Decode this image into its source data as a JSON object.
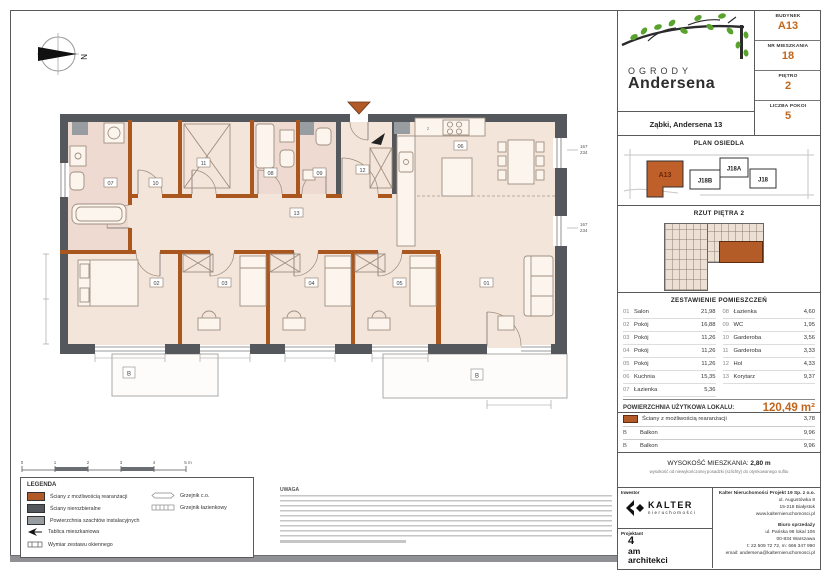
{
  "colors": {
    "accent": "#c2661c",
    "wall_accent": "#a9571f",
    "wall_dark": "#54585c",
    "shaft_gray": "#989da1",
    "floor": "#f3e5d9",
    "bath_floor": "#eedad0"
  },
  "compass": {
    "north": "N"
  },
  "plan": {
    "labels": [
      "01",
      "02",
      "03",
      "04",
      "05",
      "06",
      "07",
      "08",
      "09",
      "10",
      "11",
      "12",
      "13"
    ],
    "balcony_label": "B",
    "kitchen_z": "z",
    "win_w": "167",
    "win_h": "234"
  },
  "scalebar": {
    "t0": "0",
    "t1": "1",
    "t2": "2",
    "t3": "3",
    "t4": "4",
    "t5": "5 m"
  },
  "legend": {
    "title": "LEGENDA",
    "items": [
      {
        "label": "Ściany z możliwością rearanżacji"
      },
      {
        "label": "Ściany nierozbieralne"
      },
      {
        "label": "Powierzchnia szachtów instalacyjnych"
      },
      {
        "label": "Tablica mieszkaniowa"
      },
      {
        "label": "Wymiar zestawu okiennego"
      },
      {
        "label": "Grzejnik c.o."
      },
      {
        "label": "Grzejnik łazienkowy"
      }
    ]
  },
  "notes": {
    "title": "UWAGA"
  },
  "panel": {
    "logo": {
      "line1": "OGRODY",
      "line2": "Andersena",
      "address": "Ząbki, Andersena 13"
    },
    "info": [
      {
        "label": "BUDYNEK",
        "value": "A13"
      },
      {
        "label": "NR MIESZKANIA",
        "value": "18"
      },
      {
        "label": "PIĘTRO",
        "value": "2"
      },
      {
        "label": "LICZBA POKOI",
        "value": "5"
      }
    ],
    "site": {
      "title": "PLAN OSIEDLA",
      "buildings": [
        "A13",
        "J18B",
        "J18A",
        "J18"
      ]
    },
    "rzut": {
      "title": "RZUT PIĘTRA 2"
    },
    "table": {
      "title": "ZESTAWIENIE POMIESZCZEŃ",
      "left": [
        {
          "no": "01",
          "name": "Salon",
          "area": "21,98"
        },
        {
          "no": "02",
          "name": "Pokój",
          "area": "16,88"
        },
        {
          "no": "03",
          "name": "Pokój",
          "area": "11,26"
        },
        {
          "no": "04",
          "name": "Pokój",
          "area": "11,26"
        },
        {
          "no": "05",
          "name": "Pokój",
          "area": "11,26"
        },
        {
          "no": "06",
          "name": "Kuchnia",
          "area": "15,35"
        },
        {
          "no": "07",
          "name": "Łazienka",
          "area": "5,36"
        }
      ],
      "right": [
        {
          "no": "08",
          "name": "Łazienka",
          "area": "4,60"
        },
        {
          "no": "09",
          "name": "WC",
          "area": "1,95"
        },
        {
          "no": "10",
          "name": "Garderoba",
          "area": "3,56"
        },
        {
          "no": "11",
          "name": "Garderoba",
          "area": "3,33"
        },
        {
          "no": "12",
          "name": "Hol",
          "area": "4,33"
        },
        {
          "no": "13",
          "name": "Korytarz",
          "area": "9,37"
        }
      ]
    },
    "total": {
      "label": "POWIERZCHNIA UŻYTKOWA LOKALU:",
      "value": "120,49 m²"
    },
    "extras": [
      {
        "mark": "",
        "label": "Ściany z możliwością rearanżacji",
        "area": "3,78"
      },
      {
        "mark": "B",
        "label": "Balkon",
        "area": "9,96"
      },
      {
        "mark": "B",
        "label": "Balkon",
        "area": "9,96"
      }
    ],
    "height": {
      "label": "WYSOKOŚĆ MIESZKANIA:",
      "value": "2,80 m",
      "note": "wysokość od niewykończonej posadzki (szlichty) do otynkowanego sufitu"
    },
    "footer": {
      "inwestor_label": "Inwestor",
      "kalter": "KALTER",
      "kalter_sub": "nieruchomości",
      "projektant_label": "Projektant",
      "proj1": "4",
      "proj2": "am",
      "proj3": "architekci",
      "company": "Kalter Nieruchomości Projekt 19 Sp. z o.o.",
      "addr1": "ul. Augustówka 8",
      "addr2": "15-218 Białystok",
      "addr3": "www.kalternieruchomosci.pl",
      "office_label": "Biuro sprzedaży",
      "off1": "ul. Pańska 98 lokal 106",
      "off2": "00-834 Warszawa",
      "off3": "t: 22 509 72 72, m: 666 347 990",
      "off4": "email: andersena@kalternieruchomosci.pl"
    }
  }
}
